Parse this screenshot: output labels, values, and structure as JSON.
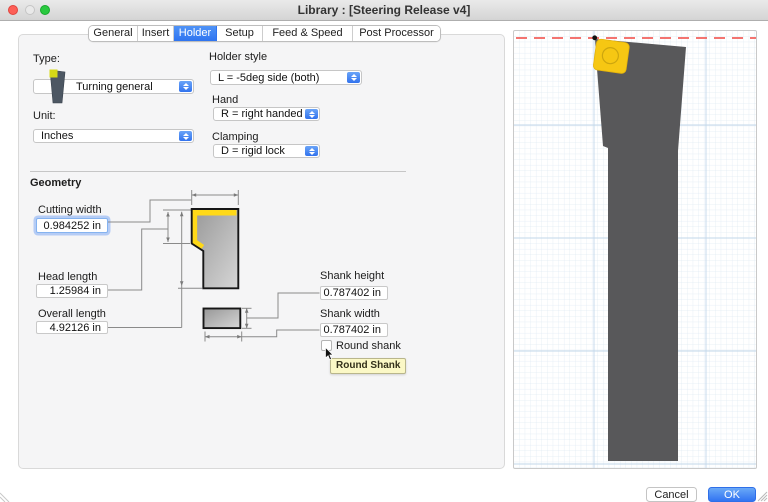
{
  "window": {
    "title": "Library : [Steering Release v4]"
  },
  "tabs": {
    "items": [
      "General",
      "Insert",
      "Holder",
      "Setup",
      "Feed & Speed",
      "Post Processor"
    ],
    "active": "Holder"
  },
  "form": {
    "type_label": "Type:",
    "type_value": "Turning general",
    "unit_label": "Unit:",
    "unit_value": "Inches",
    "holder_style_label": "Holder style",
    "holder_style_value": "L = -5deg side (both)",
    "hand_label": "Hand",
    "hand_value": "R = right handed",
    "clamping_label": "Clamping",
    "clamping_value": "D = rigid lock"
  },
  "geometry": {
    "heading": "Geometry",
    "cutting_width": {
      "label": "Cutting width",
      "value": "0.984252 in"
    },
    "head_length": {
      "label": "Head length",
      "value": "1.25984 in"
    },
    "overall_length": {
      "label": "Overall length",
      "value": "4.92126 in"
    },
    "shank_height": {
      "label": "Shank height",
      "value": "0.787402 in"
    },
    "shank_width": {
      "label": "Shank width",
      "value": "0.787402 in"
    },
    "round_shank_label": "Round shank",
    "round_shank_checked": false,
    "tooltip": "Round Shank"
  },
  "buttons": {
    "cancel": "Cancel",
    "ok": "OK"
  },
  "colors": {
    "accent_blue": "#3274f2",
    "insert_yellow": "#f6c713",
    "tool_gray": "#58585a",
    "tooltip_yellow": "#fbf8c6",
    "centerline_red": "#f2615c"
  }
}
